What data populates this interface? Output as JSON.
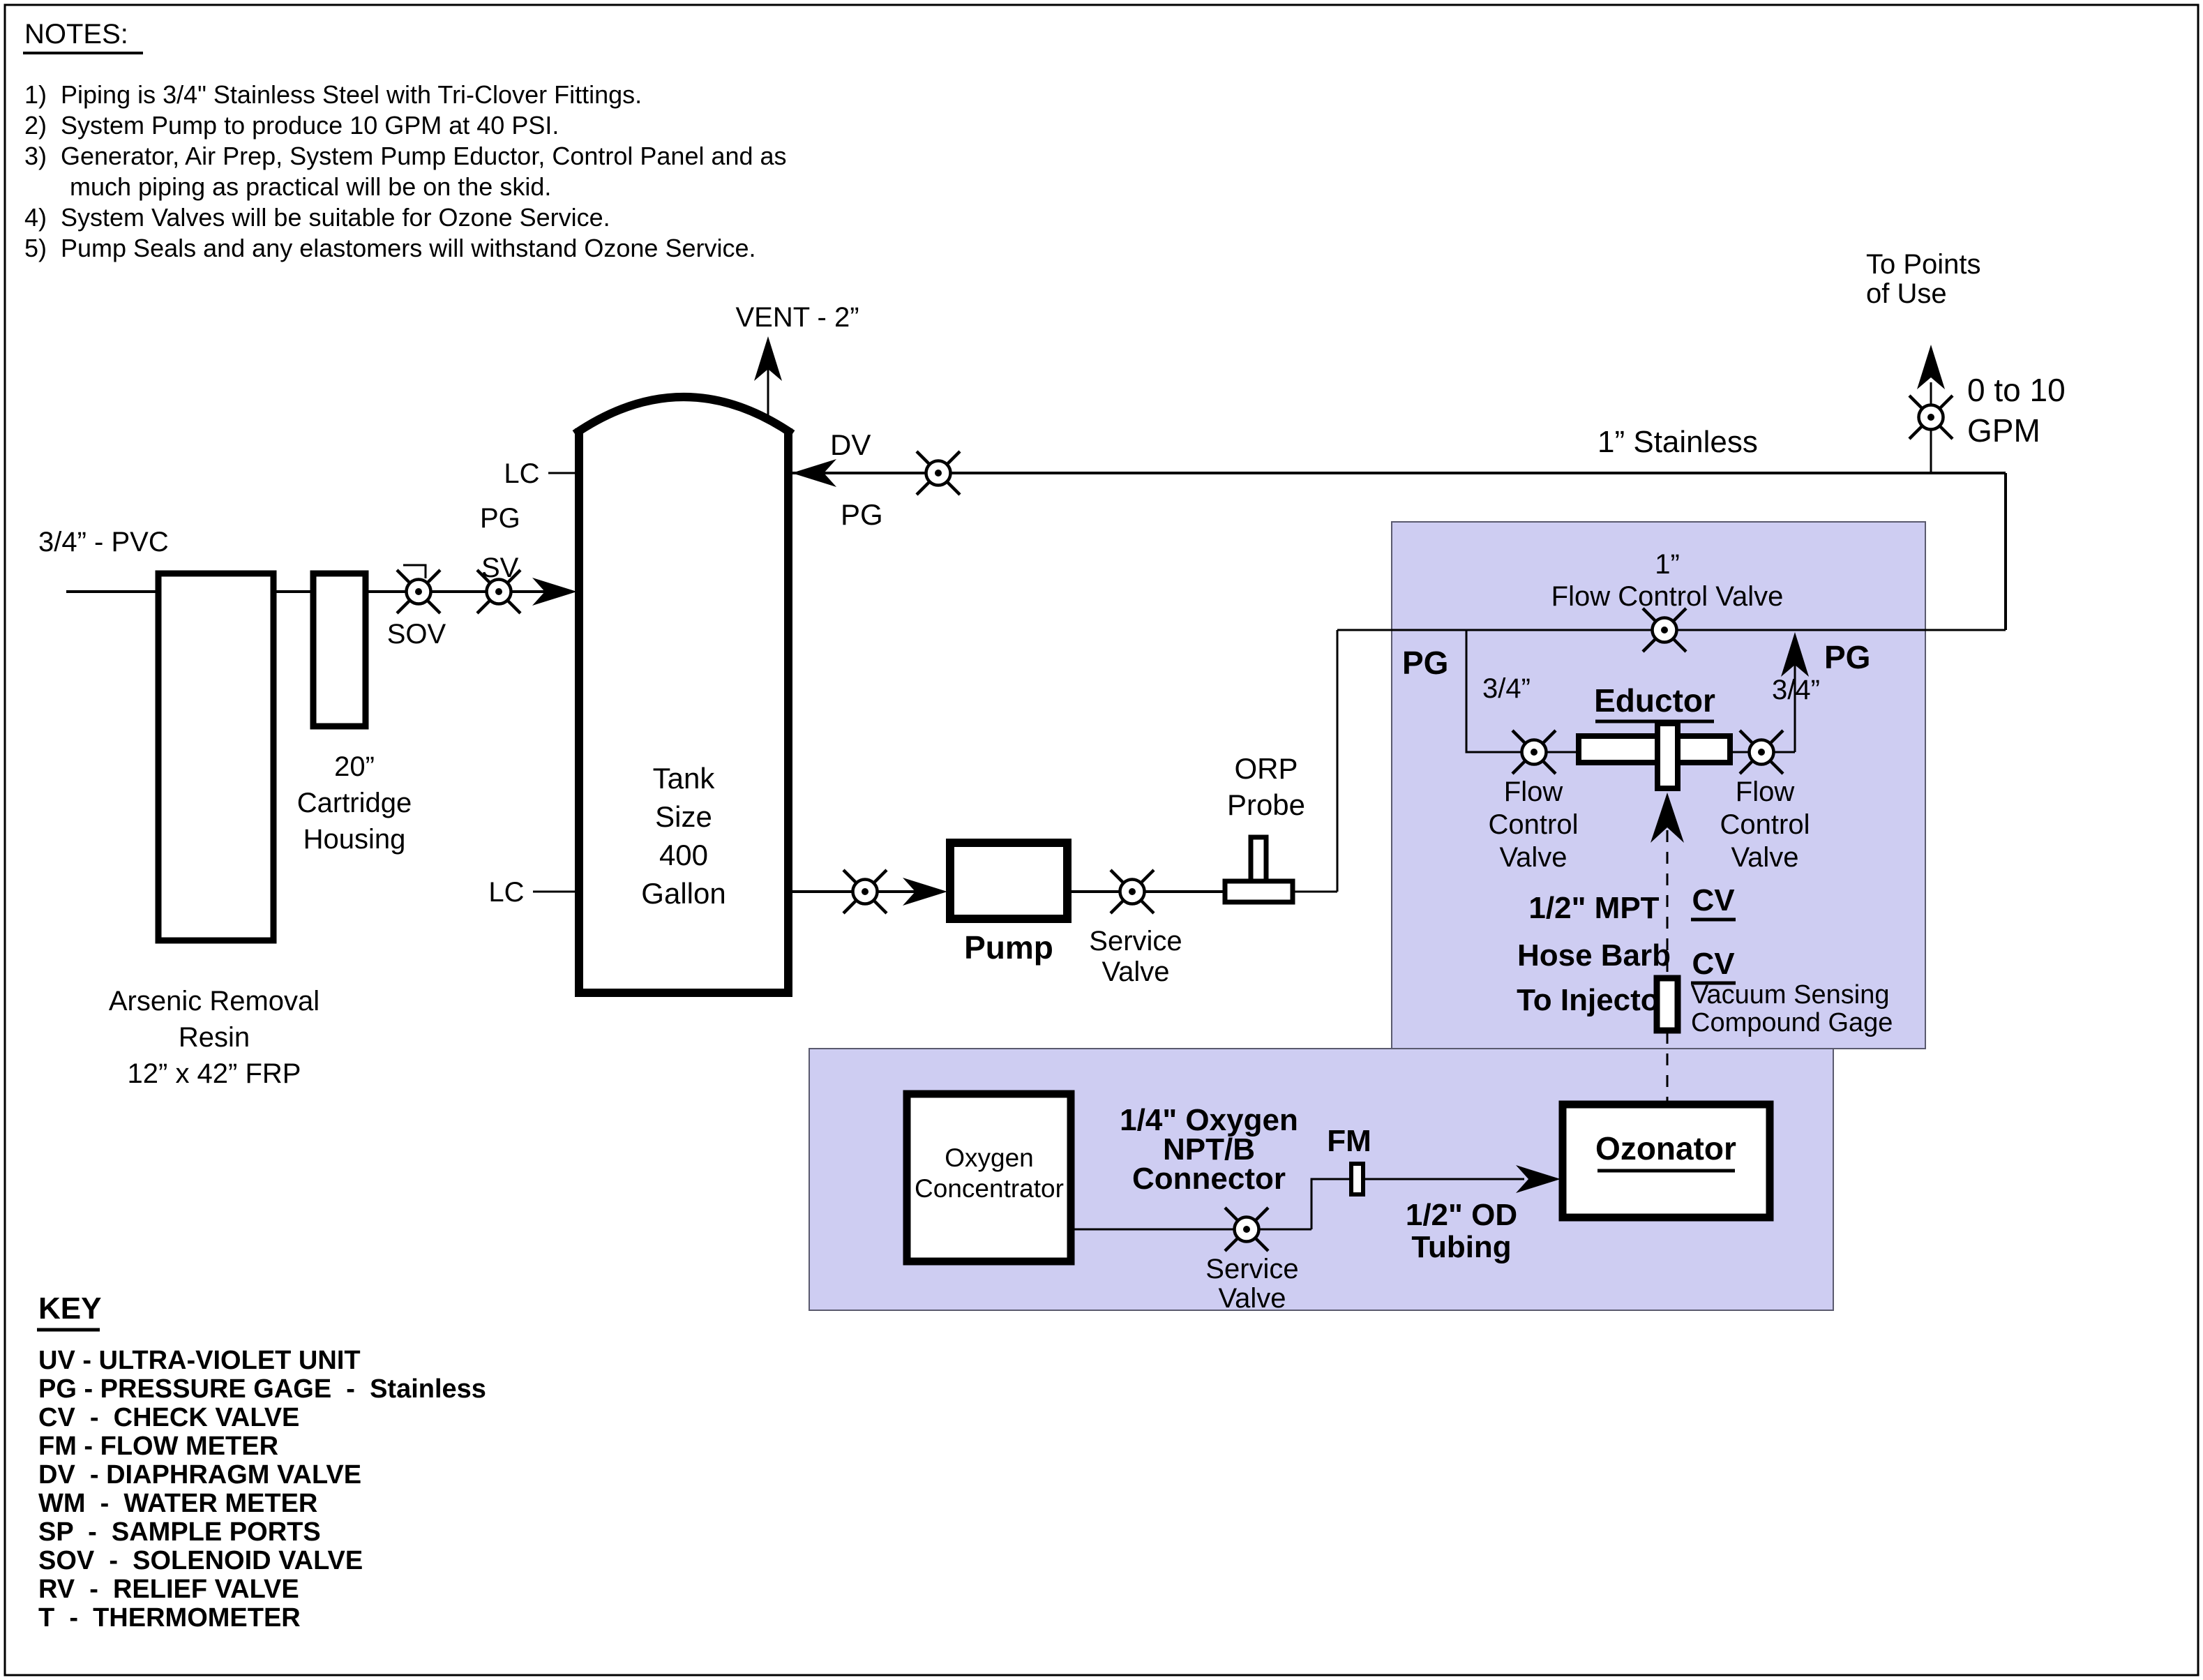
{
  "notes": {
    "heading": "NOTES:",
    "items": [
      "1)  Piping is 3/4\" Stainless Steel with Tri-Clover Fittings.",
      "2)  System Pump to produce 10 GPM at 40 PSI.",
      "3)  Generator, Air Prep, System Pump Eductor, Control Panel and as",
      "much piping as practical will be on the skid.",
      "4)  System Valves will be suitable for Ozone Service.",
      "5)  Pump Seals and any elastomers will withstand Ozone Service."
    ]
  },
  "key": {
    "heading": "KEY",
    "entries": [
      "UV - ULTRA-VIOLET UNIT",
      "PG - PRESSURE GAGE  -  Stainless",
      "CV  -  CHECK VALVE",
      "FM - FLOW METER",
      "DV  - DIAPHRAGM VALVE",
      "WM  -  WATER METER",
      "SP  -  SAMPLE PORTS",
      "SOV  -  SOLENOID VALVE",
      "RV  -  RELIEF VALVE",
      "T  -  THERMOMETER"
    ]
  },
  "main": {
    "pvc_inlet": "3/4” - PVC",
    "arsenic_vessel": [
      "Arsenic Removal",
      "Resin",
      "12” x 42” FRP"
    ],
    "cartridge": [
      "20”",
      "Cartridge",
      "Housing"
    ],
    "sov": "SOV",
    "pg_inlet": "PG",
    "sv_inlet": "SV",
    "vent": "VENT - 2”",
    "lc_top": "LC",
    "lc_bottom": "LC",
    "tank_size": [
      "Tank",
      "Size",
      "400",
      "Gallon"
    ],
    "dv": "DV",
    "pg_tank": "PG",
    "stainless": "1” Stainless",
    "to_points": [
      "To Points",
      "of Use"
    ],
    "gpm": [
      "0 to 10",
      "GPM"
    ],
    "pump": "Pump",
    "service_valve": [
      "Service",
      "Valve"
    ],
    "orp": [
      "ORP",
      "Probe"
    ]
  },
  "skid": {
    "fcv_main": [
      "1”",
      "Flow Control Valve"
    ],
    "pg_left": "PG",
    "pg_right": "PG",
    "size_left": "3/4”",
    "size_right": "3/4”",
    "eductor": "Eductor",
    "fcv_left": [
      "Flow",
      "Control",
      "Valve"
    ],
    "fcv_right": [
      "Flow",
      "Control",
      "Valve"
    ],
    "mpt": [
      "1/2\" MPT",
      "Hose Barb",
      "To Injector"
    ],
    "cv1": "CV",
    "cv2": "CV",
    "vacuum": [
      "Vacuum Sensing",
      "Compound Gage"
    ]
  },
  "generator": {
    "oxygen": [
      "Oxygen",
      "Concentrator"
    ],
    "npt": [
      "1/4\" Oxygen",
      "NPT/B",
      "Connector"
    ],
    "fm": "FM",
    "service_valve": [
      "Service",
      "Valve"
    ],
    "tubing": [
      "1/2\" OD",
      "Tubing"
    ],
    "ozonator": "Ozonator"
  },
  "colors": {
    "skid_bg": "#cecdf2",
    "panel_border": "#5a5a6e",
    "line": "#000000"
  }
}
